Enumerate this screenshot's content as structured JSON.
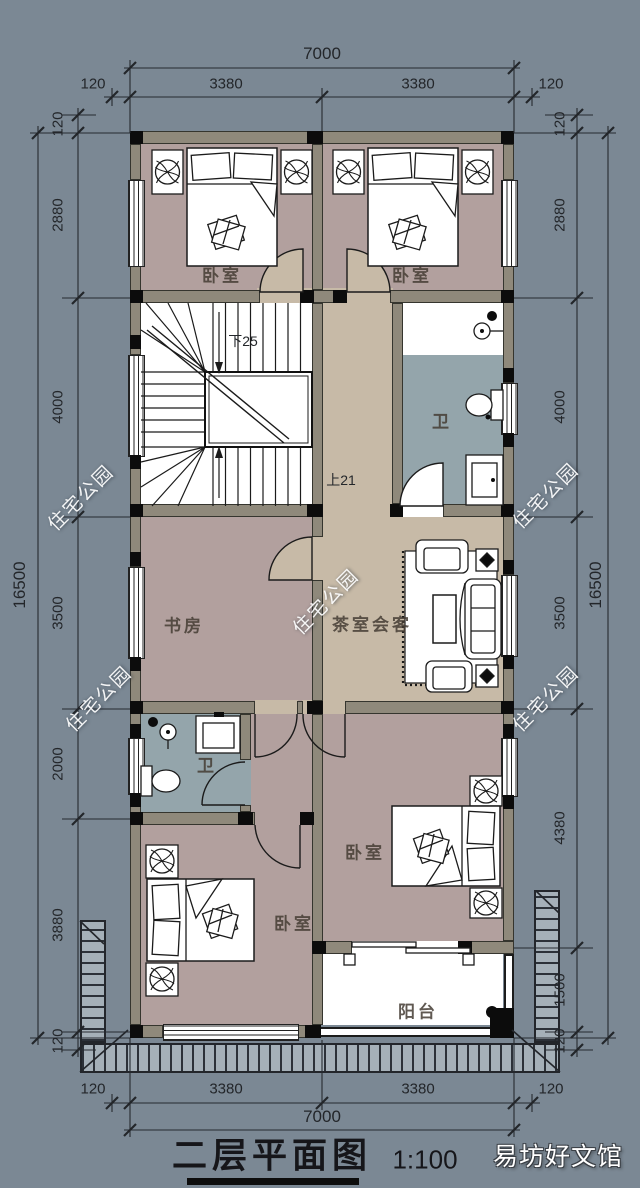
{
  "title": {
    "name": "二层平面图",
    "scale": "1:100"
  },
  "brand_watermark": "易坊好文馆",
  "diagonal_watermark": "住宅公园",
  "rooms": {
    "bedroom_tl": "卧室",
    "bedroom_tr": "卧室",
    "study": "书房",
    "tea_room": "茶室会客",
    "bath_top": "卫",
    "bath_bottom": "卫",
    "bedroom_bl": "卧室",
    "bedroom_br": "卧室",
    "balcony": "阳台"
  },
  "stairs": {
    "down_label": "下25",
    "up_label": "上21"
  },
  "dimensions": {
    "top": {
      "overall": "7000",
      "segments": [
        "120",
        "3380",
        "3380",
        "120"
      ]
    },
    "bottom": {
      "overall": "7000",
      "segments": [
        "120",
        "3380",
        "3380",
        "120"
      ]
    },
    "left": {
      "overall": "16500",
      "segments": [
        "120",
        "2880",
        "4000",
        "3500",
        "2000",
        "3880",
        "120"
      ]
    },
    "right": {
      "overall": "16500",
      "segments": [
        "120",
        "2880",
        "4000",
        "3500",
        "4380",
        "1500",
        "120"
      ]
    }
  },
  "colors": {
    "background": "#7b8894",
    "wall": "#8f897b",
    "floor_bedroom": "#b2a09e",
    "floor_hall": "#c7baa7",
    "floor_bath": "#94a5ab",
    "stair_floor": "#ffffff",
    "watermark_text": "#ffffff",
    "line": "#1b1b1b"
  }
}
